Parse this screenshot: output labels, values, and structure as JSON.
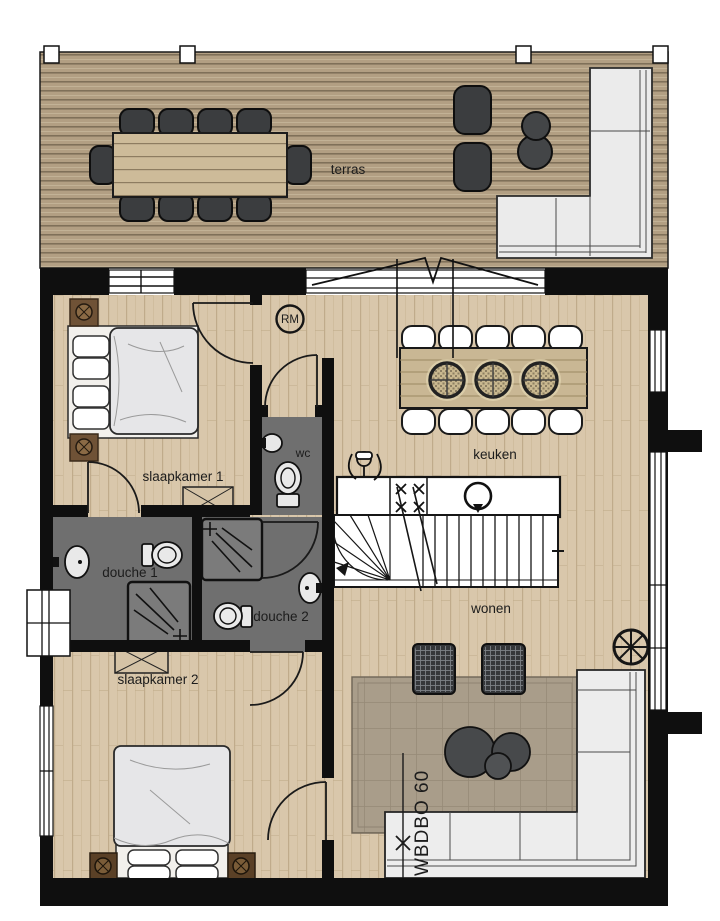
{
  "rooms": {
    "terras": {
      "label": "terras"
    },
    "slaapkamer1": {
      "label": "slaapkamer 1"
    },
    "slaapkamer2": {
      "label": "slaapkamer 2"
    },
    "douche1": {
      "label": "douche 1"
    },
    "douche2": {
      "label": "douche 2"
    },
    "wc": {
      "label": "wc"
    },
    "keuken": {
      "label": "keuken"
    },
    "wonen": {
      "label": "wonen"
    }
  },
  "annotations": {
    "smoke_detector": {
      "label": "RM"
    },
    "fire_rating": {
      "label": "WBDBO 60"
    }
  },
  "colors": {
    "wall": "#0f0f0f",
    "interior_floor": "#d9c7ab",
    "deck": "#b29f83",
    "tile_gray": "#6f6f6f",
    "furniture_dark": "#3b3d3f",
    "furniture_light": "#ececec",
    "table_wood": "#c9b794",
    "rug": "#a99d8a",
    "nightstand_wood": "#6f5236",
    "label_text": "#1c1c1c"
  }
}
